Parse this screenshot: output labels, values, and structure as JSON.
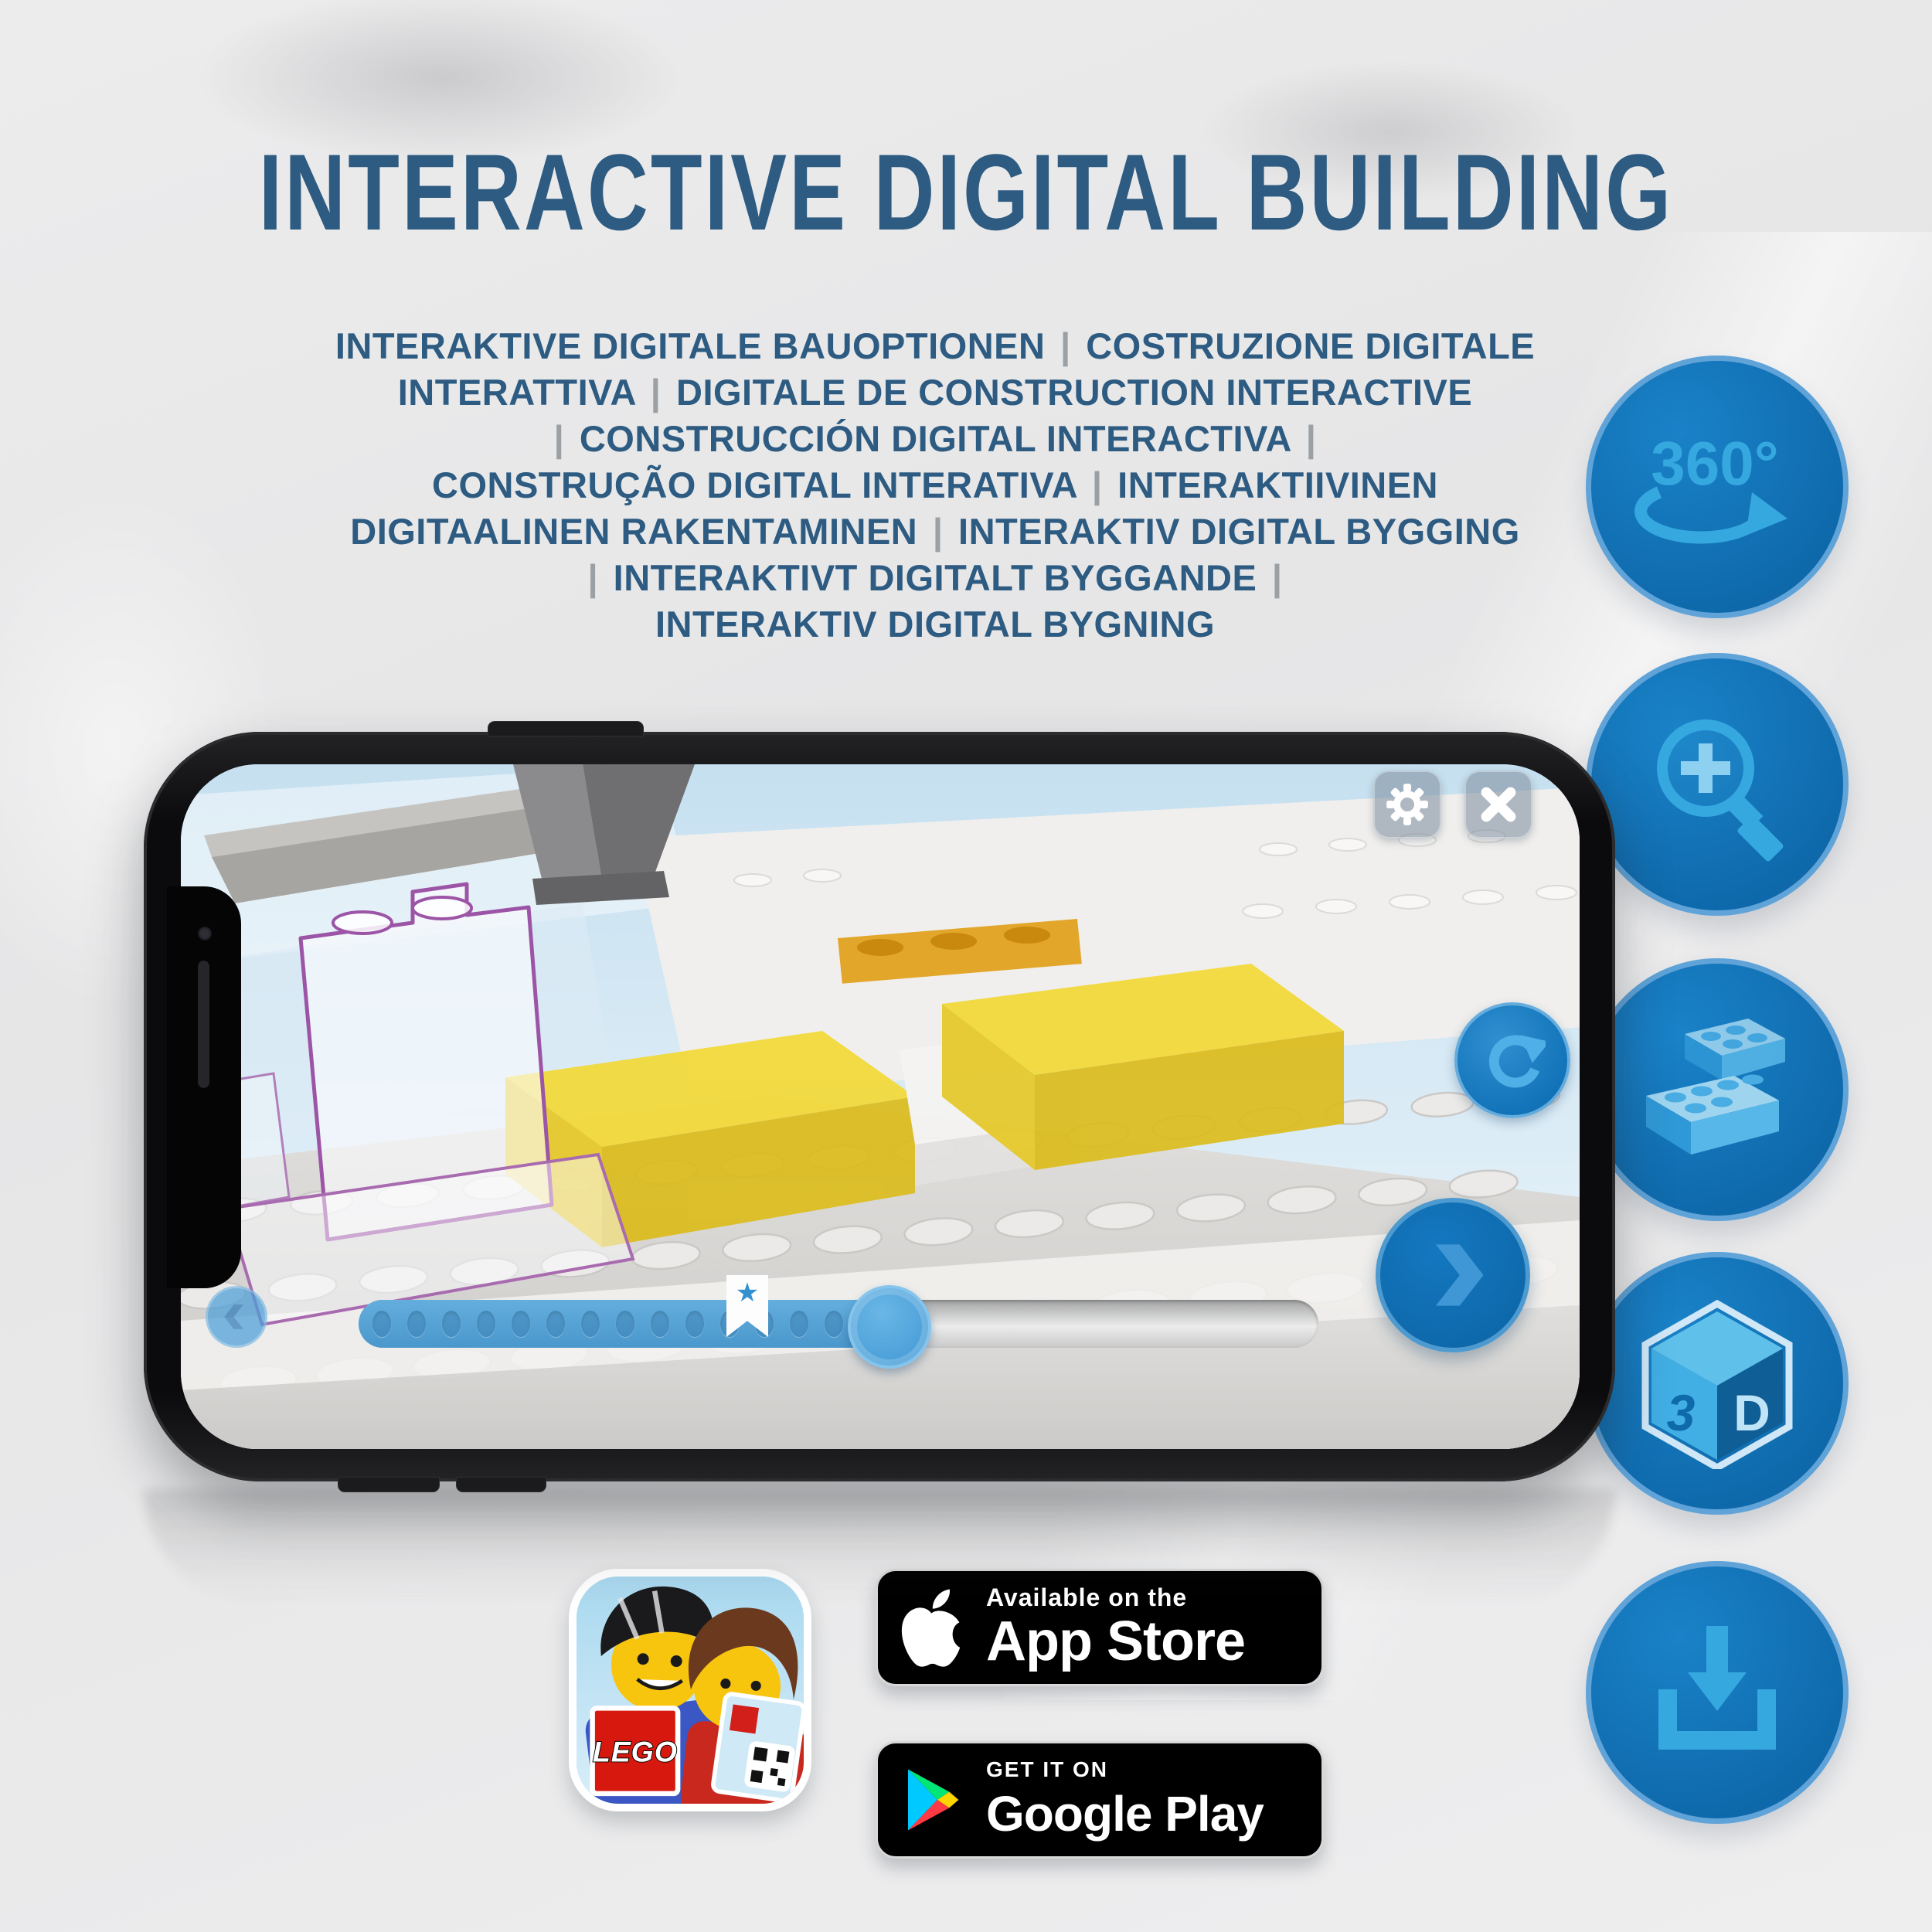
{
  "header": {
    "title": "INTERACTIVE DIGITAL BUILDING"
  },
  "subtitle": {
    "lines": [
      "INTERAKTIVE DIGITALE BAUOPTIONEN | COSTRUZIONE DIGITALE",
      "INTERATTIVA | DIGITALE DE CONSTRUCTION INTERACTIVE",
      "| CONSTRUCCIÓN DIGITAL INTERACTIVA |",
      "CONSTRUÇÃO DIGITAL INTERATIVA | INTERAKTIIVINEN",
      "DIGITAALINEN RAKENTAMINEN | INTERAKTIV DIGITAL BYGGING",
      "| INTERAKTIVT DIGITALT BYGGANDE |",
      "INTERAKTIV DIGITAL BYGNING"
    ]
  },
  "feature_icons": [
    {
      "id": "rotate-360-icon",
      "label": "360°"
    },
    {
      "id": "zoom-in-icon"
    },
    {
      "id": "stacked-bricks-icon"
    },
    {
      "id": "3d-cube-icon",
      "face_left": "3",
      "face_right": "D"
    },
    {
      "id": "download-icon"
    }
  ],
  "phone_app": {
    "buttons": {
      "settings": "gear-icon",
      "close": "close-x-icon",
      "rotate_model": "refresh-icon",
      "previous": "chevron-left-icon",
      "next": "chevron-right-icon"
    },
    "slider": {
      "star_marker": "★",
      "progress_dots": 15
    }
  },
  "badges": {
    "lego_app": {
      "logo_text": "LEGO"
    },
    "app_store": {
      "tagline": "Available on the",
      "store_name": "App Store"
    },
    "google_play": {
      "tagline": "GET IT ON",
      "store_name": "Google Play"
    }
  },
  "colors": {
    "title_blue": "#2d5b81",
    "icon_circle_blue": "#0f6cae",
    "icon_glyph_blue": "#35a8e0",
    "app_accent_blue": "#4ba0d9",
    "brick_yellow": "#eed53a",
    "ghost_outline_purple": "#9c55a6",
    "separator_grey": "#9aa0a4"
  }
}
